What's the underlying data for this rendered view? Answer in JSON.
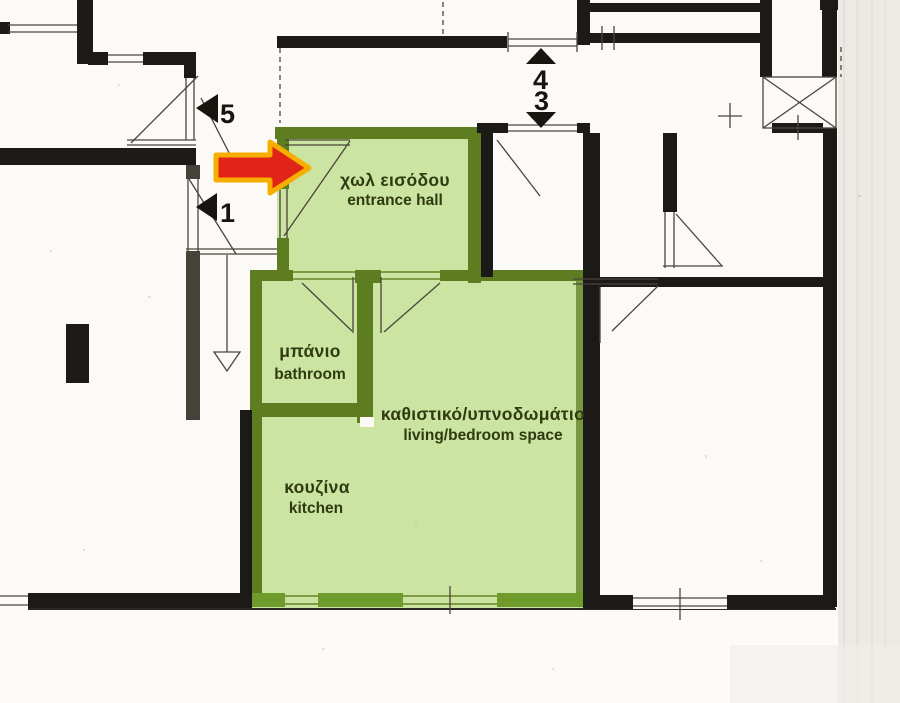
{
  "colors": {
    "paper": "#fbfaf6",
    "paper_edge": "#eceae4",
    "paper_streak": "#dcd9d2",
    "wall_black": "#1c1a17",
    "wall_hatch": "#45423a",
    "wall_olive": "#5e7d20",
    "wall_olive_bright": "#6f9a2c",
    "room_fill": "#cbe4a1",
    "label_ink": "#2f3a10",
    "marker_ink": "#17150f",
    "arrow_red": "#e02418",
    "arrow_outline": "#f7ae00",
    "line_thin": "#4a453d"
  },
  "rooms": [
    {
      "id": "entrance-hall",
      "name_el": "χωλ εισόδου",
      "name_en": "entrance hall"
    },
    {
      "id": "bathroom",
      "name_el": "μπάνιο",
      "name_en": "bathroom"
    },
    {
      "id": "living-bedroom",
      "name_el": "καθιστικό/υπνοδωμάτιο",
      "name_en": "living/bedroom space"
    },
    {
      "id": "kitchen",
      "name_el": "κουζίνα",
      "name_en": "kitchen"
    }
  ],
  "unit_markers": [
    {
      "label": "5",
      "direction": "left"
    },
    {
      "label": "1",
      "direction": "left"
    },
    {
      "label": "4",
      "direction": "up"
    },
    {
      "label": "3",
      "direction": "down"
    }
  ],
  "annotations": {
    "arrow_icon": "red-entrance-arrow"
  }
}
